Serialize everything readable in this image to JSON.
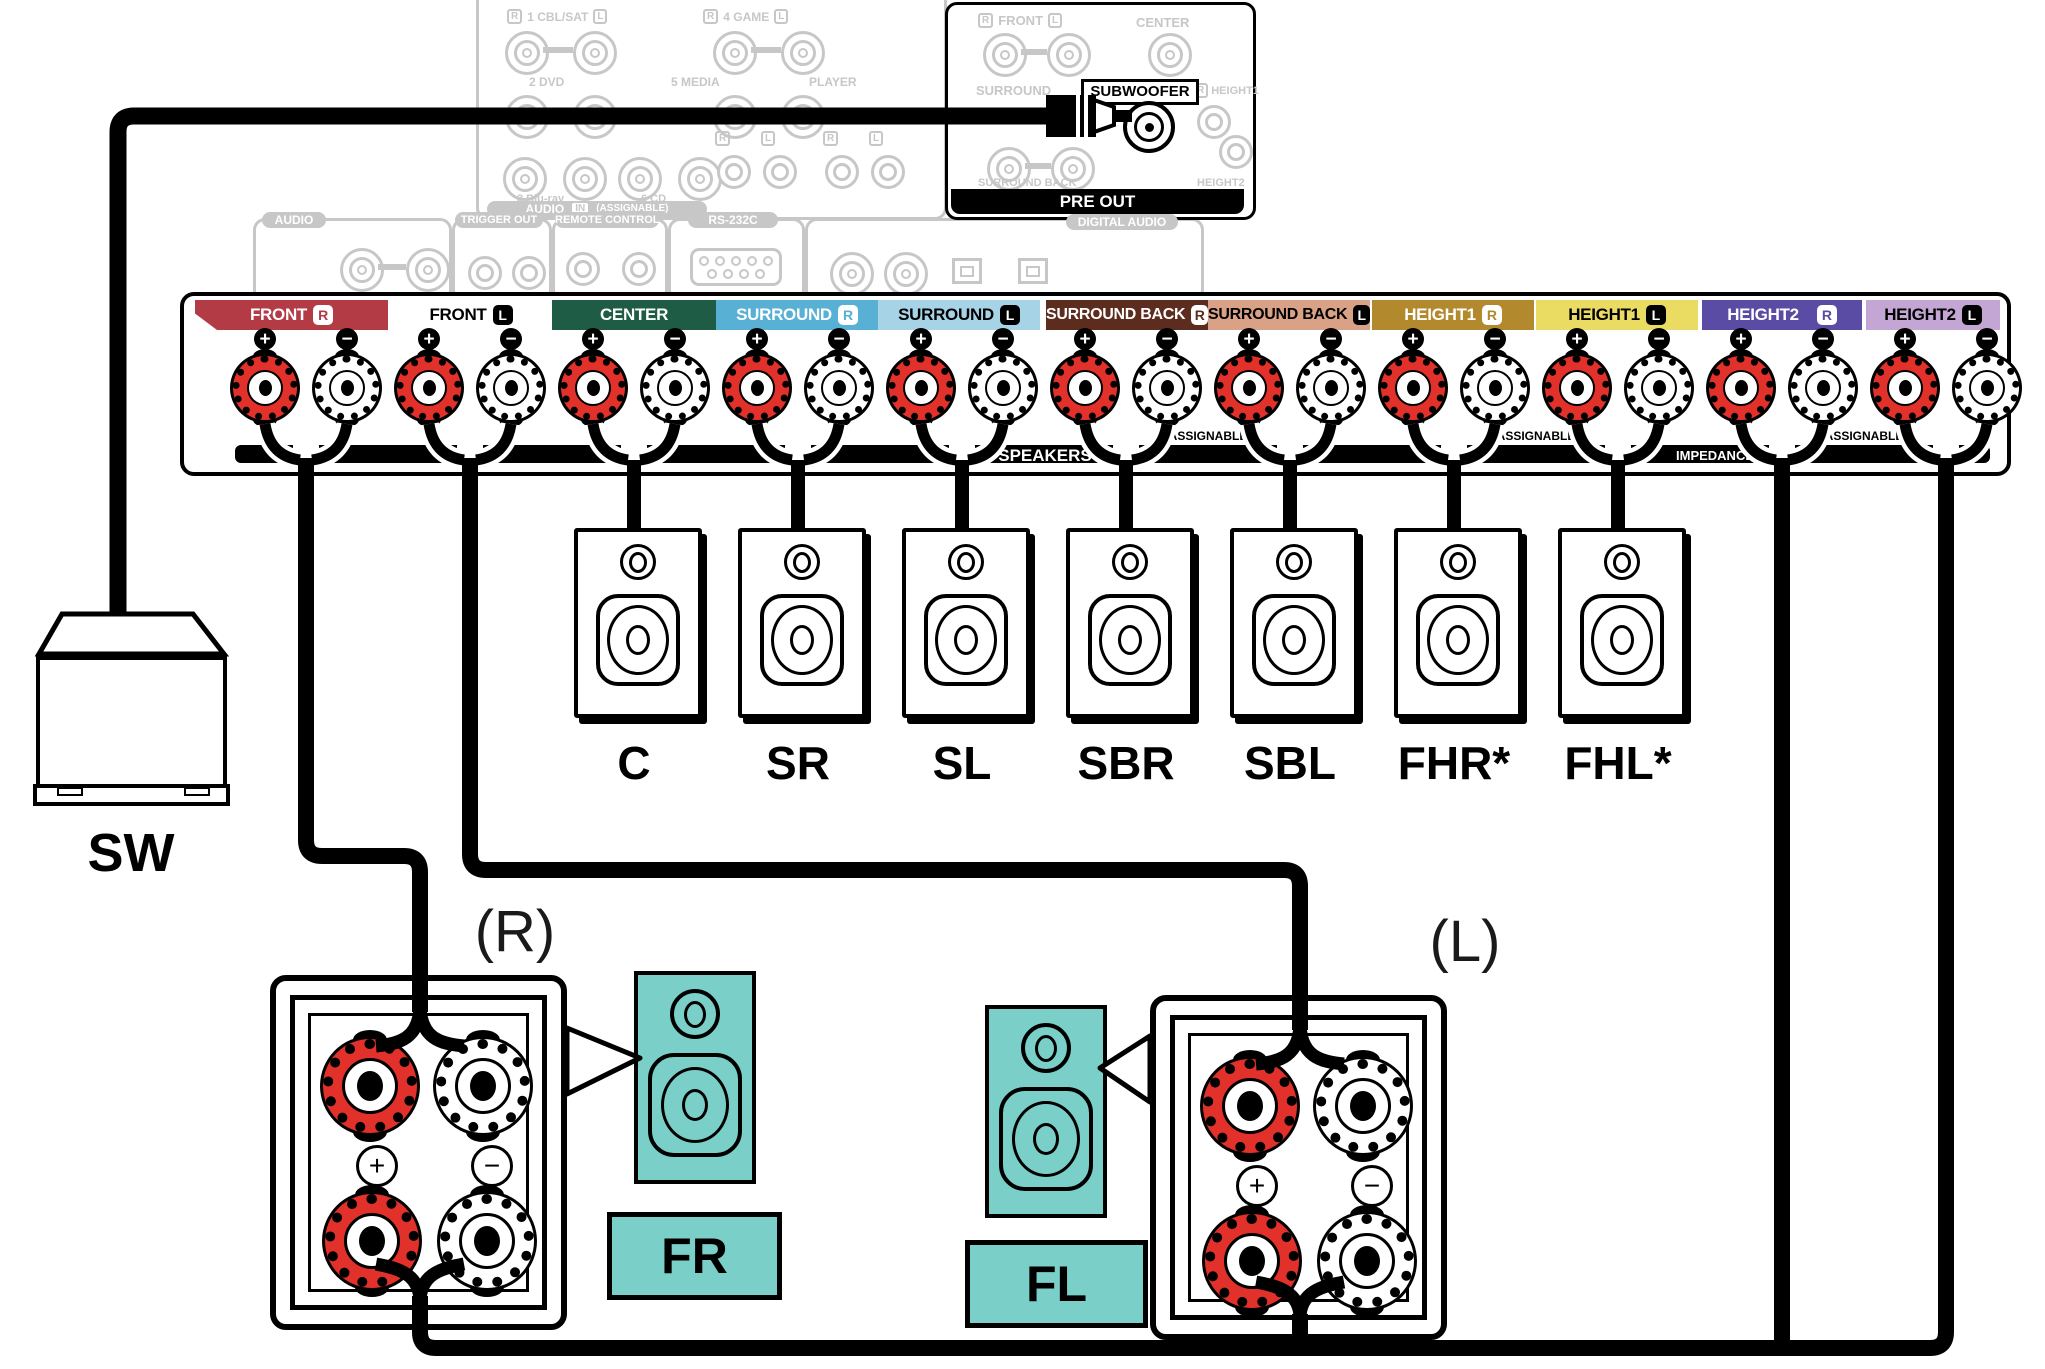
{
  "common": {
    "r": "R",
    "l": "L",
    "in": "IN",
    "out": "OUT",
    "one": "1",
    "two": "2",
    "plus": "+",
    "minus": "−",
    "assignable": "(ASSIGNABLE)"
  },
  "pre_out": {
    "front": "FRONT",
    "center": "CENTER",
    "surround": "SURROUND",
    "subwoofer": "SUBWOOFER",
    "height1": "HEIGHT1",
    "surround_back": "SURROUND BACK",
    "height2": "HEIGHT2",
    "bar_label": "PRE OUT"
  },
  "audio_in_panel": {
    "cbl_sat": "1 CBL/SAT",
    "game": "4 GAME",
    "dvd": "2 DVD",
    "media": "5 MEDIA",
    "player": "PLAYER",
    "bluray": "3 Blu-ray",
    "cd": "6 CD",
    "audio": "AUDIO"
  },
  "io_panels": {
    "audio": "AUDIO",
    "phono": "PHONO",
    "trigger_out": "TRIGGER OUT",
    "trigger_spec": "DC12V 150mA MAX.",
    "remote_control": "REMOTE CONTROL",
    "ir": "IR",
    "rs232c": "RS-232C",
    "straight_cable": "STRAIGHT CABLE",
    "coaxial": "COAXIAL",
    "coax_cbl": "1 CBL/SAT",
    "coax_dvd": "2 DVD",
    "tv": "TV",
    "audio2": "AUDIO",
    "optical": "OPTICAL",
    "cd": "CD",
    "digital_audio": "DIGITAL AUDIO"
  },
  "terminals": {
    "bands": [
      {
        "name": "FRONT",
        "ch": "R",
        "bg": "#B33B46",
        "fg": "#FFFFFF",
        "box_bg": "#FFFFFF",
        "box_fg": "#B33B46"
      },
      {
        "name": "FRONT",
        "ch": "L",
        "bg": "#FFFFFF",
        "fg": "#000000",
        "box_bg": "#000000",
        "box_fg": "#FFFFFF"
      },
      {
        "name": "CENTER",
        "ch": "",
        "bg": "#1F5C45",
        "fg": "#FFFFFF",
        "box_bg": "",
        "box_fg": ""
      },
      {
        "name": "SURROUND",
        "ch": "R",
        "bg": "#58B0D4",
        "fg": "#FFFFFF",
        "box_bg": "#FFFFFF",
        "box_fg": "#58B0D4"
      },
      {
        "name": "SURROUND",
        "ch": "L",
        "bg": "#A6D3E6",
        "fg": "#000000",
        "box_bg": "#000000",
        "box_fg": "#FFFFFF"
      },
      {
        "name": "SURROUND BACK",
        "ch": "R",
        "bg": "#5C2D1E",
        "fg": "#FFFFFF",
        "box_bg": "#FFFFFF",
        "box_fg": "#5C2D1E"
      },
      {
        "name": "SURROUND BACK",
        "ch": "L",
        "bg": "#D9A287",
        "fg": "#000000",
        "box_bg": "#000000",
        "box_fg": "#FFFFFF"
      },
      {
        "name": "HEIGHT1",
        "ch": "R",
        "bg": "#B3892E",
        "fg": "#FFFFFF",
        "box_bg": "#FFFFFF",
        "box_fg": "#B3892E"
      },
      {
        "name": "HEIGHT1",
        "ch": "L",
        "bg": "#EADB63",
        "fg": "#000000",
        "box_bg": "#000000",
        "box_fg": "#FFFFFF"
      },
      {
        "name": "HEIGHT2",
        "ch": "R",
        "bg": "#5A4BA5",
        "fg": "#FFFFFF",
        "box_bg": "#FFFFFF",
        "box_fg": "#5A4BA5"
      },
      {
        "name": "HEIGHT2",
        "ch": "L",
        "bg": "#C3A6D3",
        "fg": "#000000",
        "box_bg": "#000000",
        "box_fg": "#FFFFFF"
      }
    ],
    "bar": {
      "speakers": "SPEAKERS",
      "impedance": "IMPEDANCE : 4–16 Ω",
      "assignable": "ASSIGNABLE"
    }
  },
  "speakers": {
    "items": [
      {
        "label": "C"
      },
      {
        "label": "SR"
      },
      {
        "label": "SL"
      },
      {
        "label": "SBR"
      },
      {
        "label": "SBL"
      },
      {
        "label": "FHR*"
      },
      {
        "label": "FHL*"
      }
    ]
  },
  "subwoofer": {
    "label": "SW"
  },
  "front_right": {
    "position": "(R)",
    "label": "FR"
  },
  "front_left": {
    "position": "(L)",
    "label": "FL"
  },
  "colors": {
    "post_red": "#E2312A",
    "teal": "#7ACFC8",
    "faded_gray": "#C7C7C7",
    "band_bar": "#000000"
  }
}
